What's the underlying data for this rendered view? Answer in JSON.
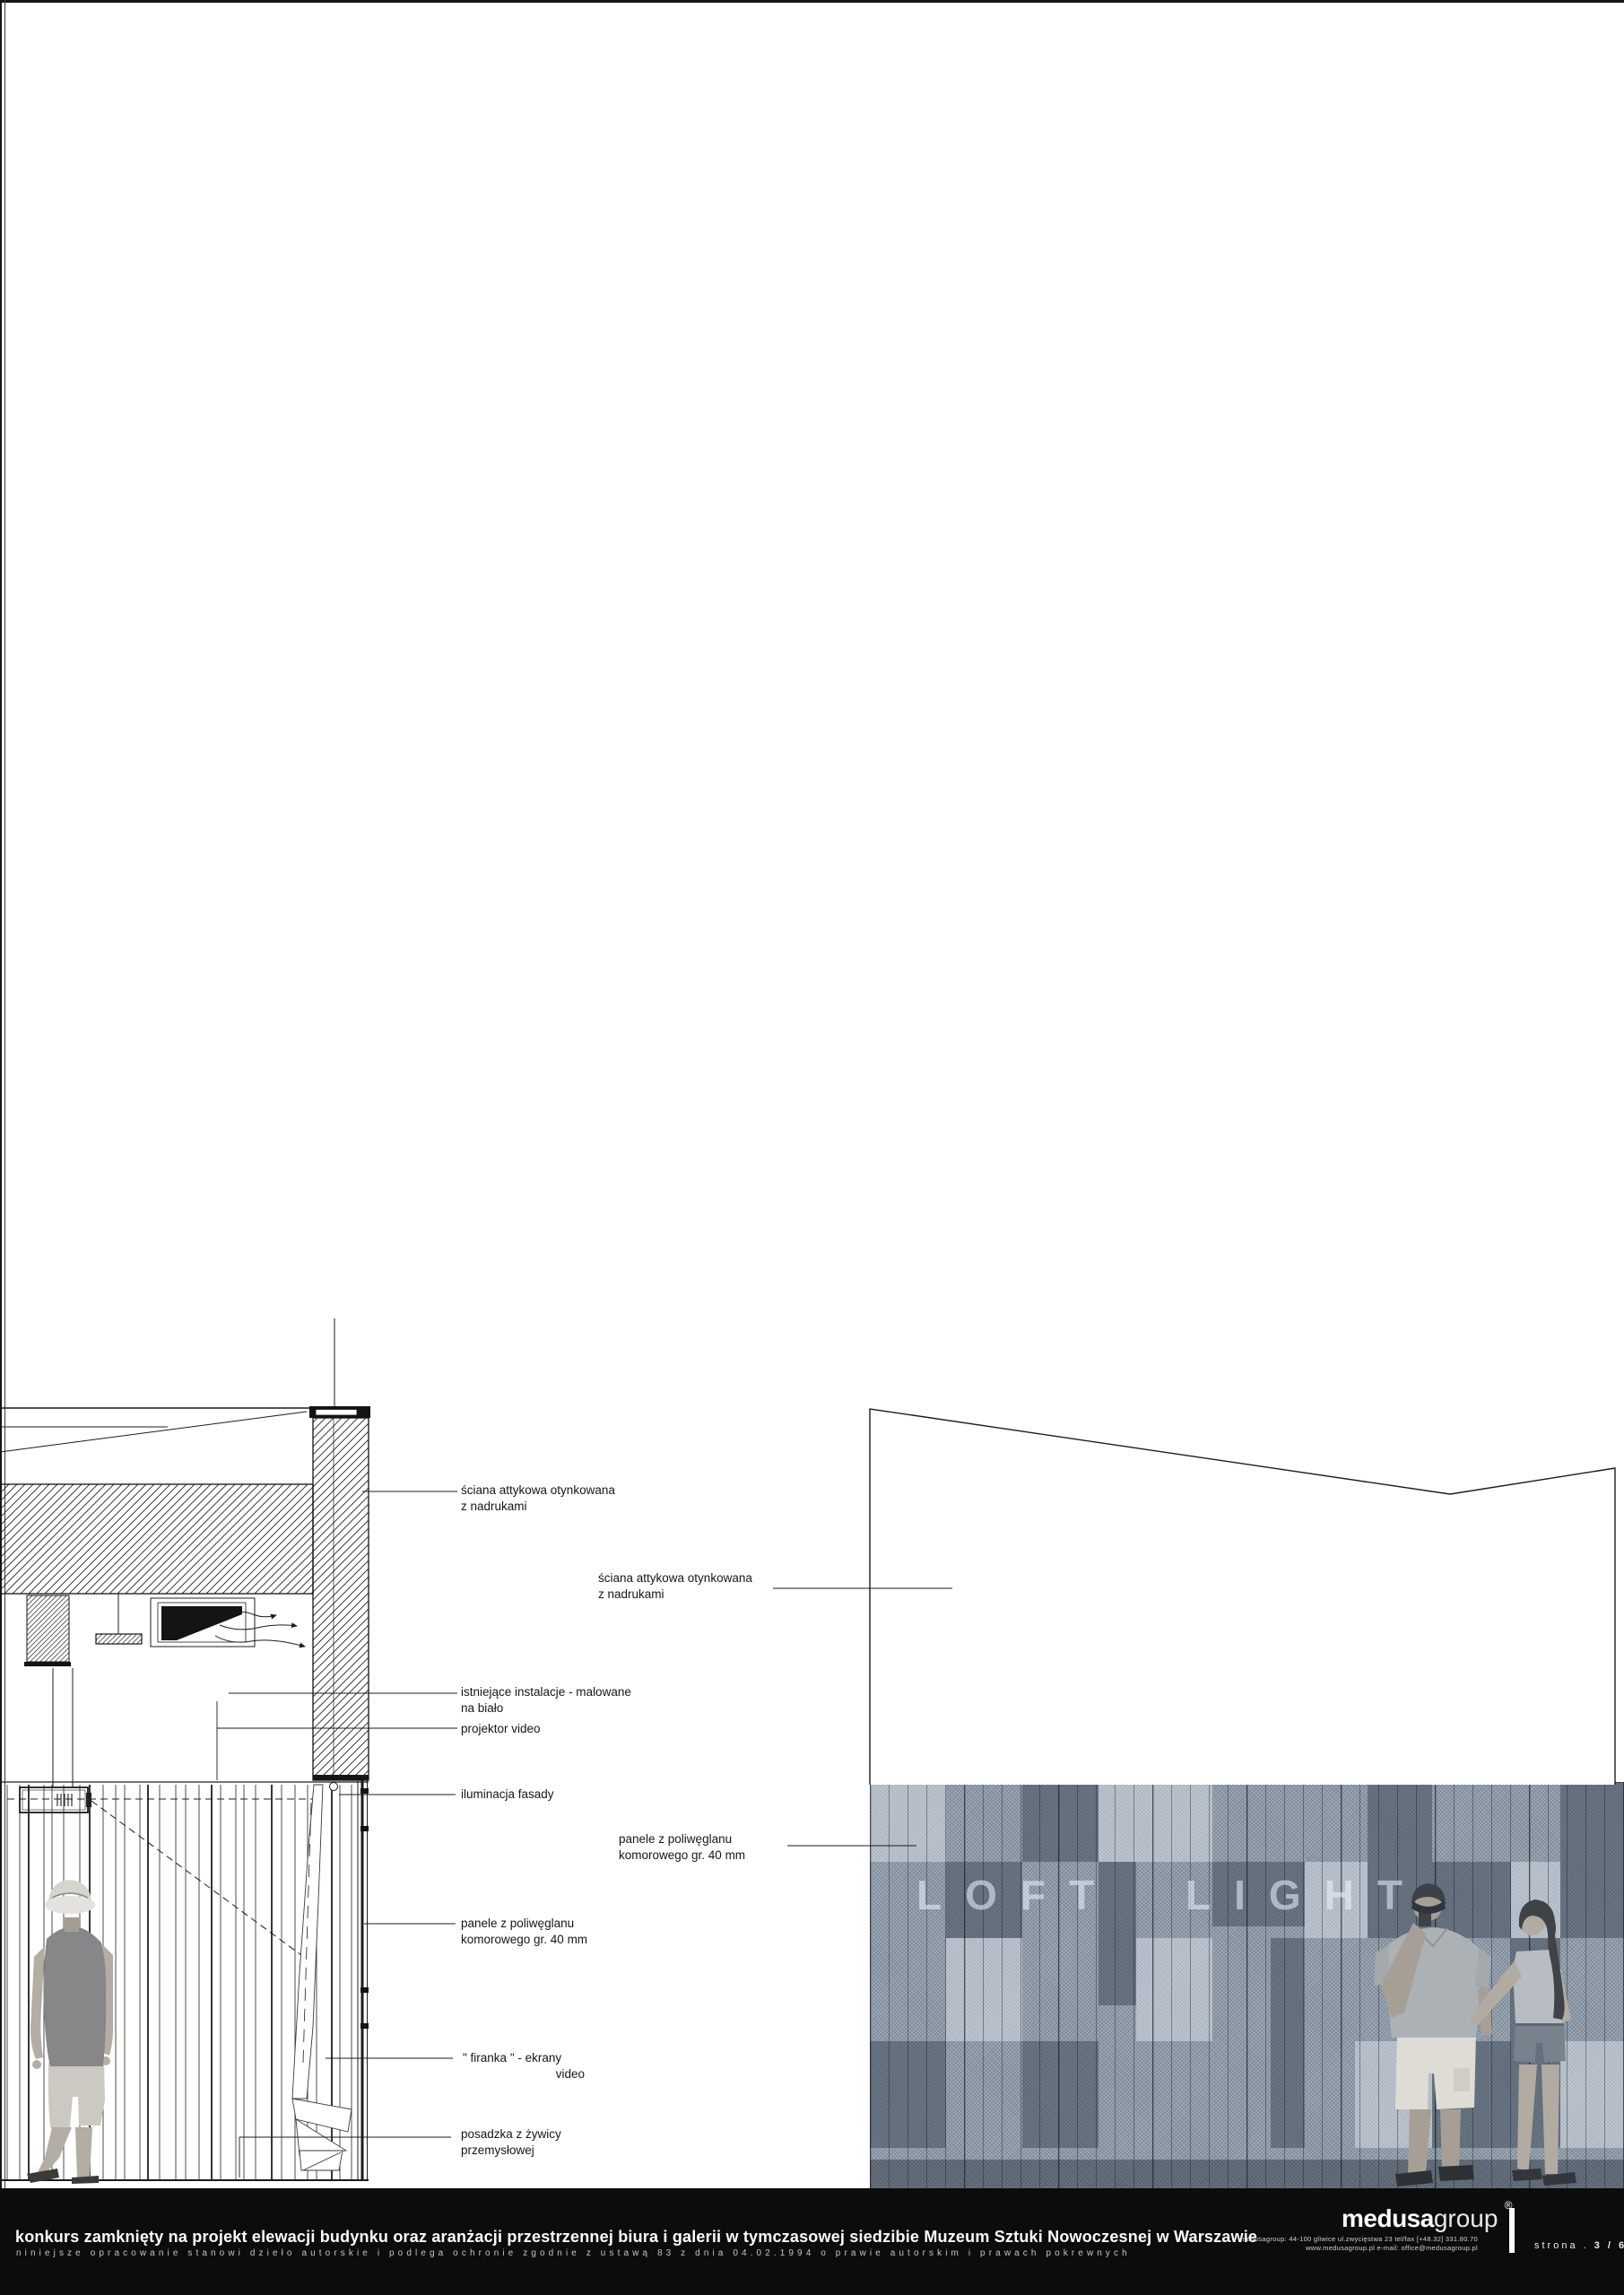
{
  "labels_left": [
    {
      "line1": "ściana attykowa otynkowana",
      "line2": "z nadrukami"
    },
    {
      "line1": "istniejące instalacje - malowane",
      "line2": "na biało"
    },
    {
      "line1": "projektor video",
      "line2": ""
    },
    {
      "line1": "iluminacja fasady",
      "line2": ""
    },
    {
      "line1": "panele z poliwęglanu",
      "line2": "komorowego gr. 40 mm"
    },
    {
      "line1": "\" firanka \" - ekrany",
      "line2": "video"
    },
    {
      "line1": "posadzka z żywicy",
      "line2": "przemysłowej"
    }
  ],
  "labels_right": [
    {
      "line1": "ściana attykowa otynkowana",
      "line2": "z nadrukami"
    },
    {
      "line1": "panele z poliwęglanu",
      "line2": "komorowego gr. 40 mm"
    }
  ],
  "photo": {
    "sign_word_1": "LOFT",
    "sign_word_2": "LIGHT"
  },
  "footer": {
    "title": "konkurs zamknięty na projekt elewacji budynku oraz aranżacji przestrzennej biura i galerii w tymczasowej siedzibie Muzeum Sztuki Nowoczesnej w Warszawie",
    "disclaimer": "niniejsze opracowanie stanowi dzieło autorskie i podlega ochronie zgodnie z ustawą 83 z dnia 04.02.1994 o prawie autorskim i prawach pokrewnych",
    "logo_bold": "medusa",
    "logo_light": "group",
    "registered_mark": "®",
    "address_line1": "medusagroup: 44-100 gliwice ul.zwycięstwa 23  tel/fax [+48.32] 331.80.70",
    "address_line2": "www.medusagroup.pl e-mail: office@medusagroup.pl",
    "page_label": "strona .",
    "page_number": "3 / 6"
  },
  "colors": {
    "ink": "#1c1c1c",
    "footer_bg": "#0c0c0c",
    "photo_base": "#8c9aa8"
  }
}
